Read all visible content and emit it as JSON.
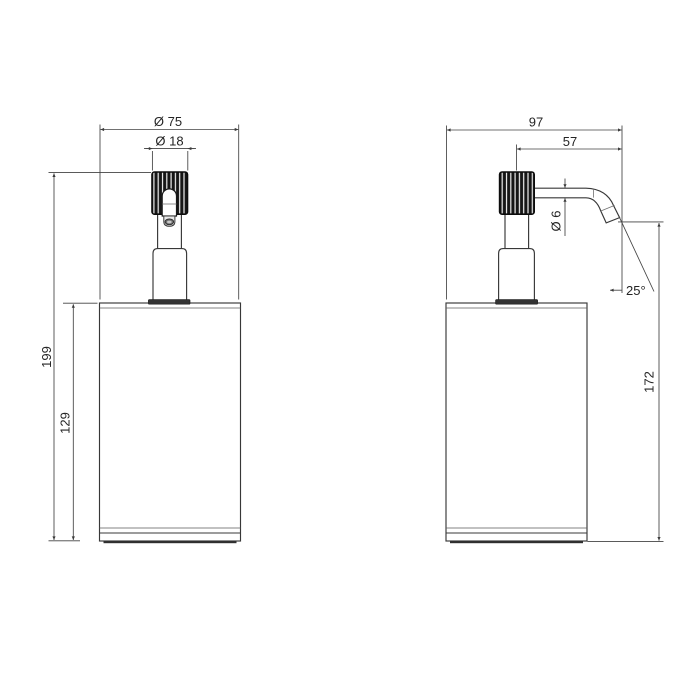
{
  "colors": {
    "line": "#383838",
    "dark_fill": "#333333",
    "background": "#ffffff"
  },
  "dims": {
    "front": {
      "body_diameter": "Ø 75",
      "pump_diameter": "Ø 18",
      "total_height": "199",
      "body_height": "129"
    },
    "side": {
      "total_depth": "97",
      "spout_reach": "57",
      "spout_diameter": "Ø 6",
      "spout_angle": "25°",
      "spout_outlet_height": "172"
    }
  }
}
